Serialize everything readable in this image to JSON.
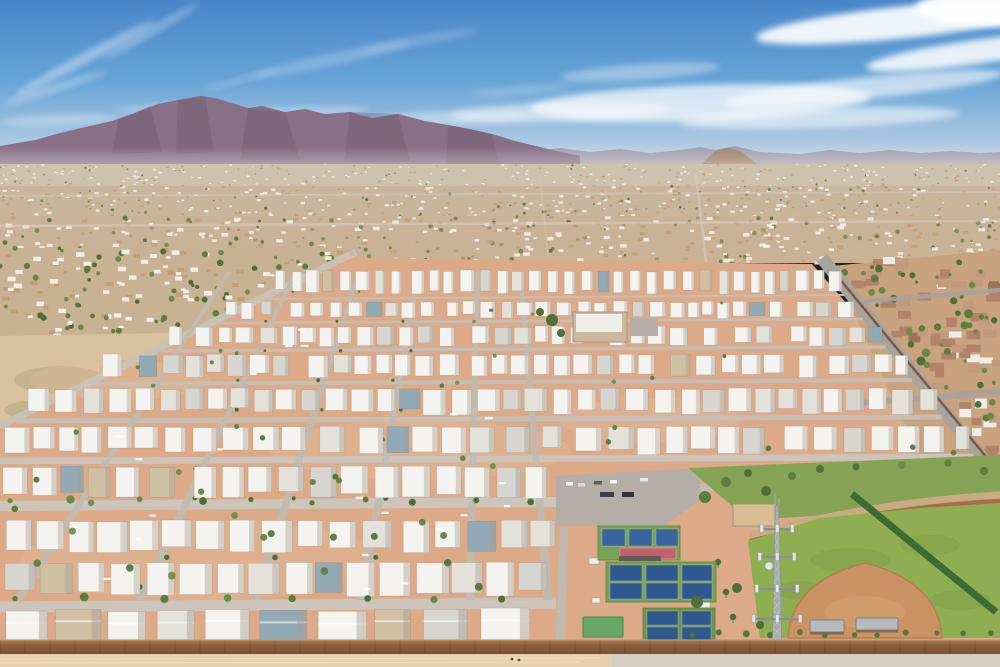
{
  "scene": {
    "description": "Aerial drone photograph of a desert mobile-home community with mountain range on the horizon, dense suburban sprawl, grid of white-roofed mobile homes, pickleball courts, baseball field and a cell tower",
    "width": 1000,
    "height": 667
  },
  "palette": {
    "sky_top": "#4a86c8",
    "sky_mid": "#66a3d6",
    "sky_low": "#a9c6e0",
    "sky_horizon": "#d8e3ea",
    "cloud": "#ffffff",
    "mountain": "#887088",
    "mountain_dark": "#6b5568",
    "mountain_far": "#9a8d9c",
    "foothill": "#9c7a5a",
    "sprawl_roof_white": "#f1efe8",
    "sprawl_roof_tan": "#c49c74",
    "sprawl_dark": "#9b8a74",
    "tree": "#5d7c3e",
    "tree_dark": "#4e7038",
    "tree_light": "#6b8a4a",
    "palm": "#47703a",
    "park_ground": "#dcaa88",
    "park_ground_light": "#e5bd9c",
    "street": "#c6c0b8",
    "street_bright": "#cdc7be",
    "vert_street": "#c0bab1",
    "home_white": "#f4f3ef",
    "home_light": "#e3e1da",
    "home_gray": "#d6d5cf",
    "home_blue": "#92aab6",
    "home_tan": "#cfc0a4",
    "home_shade": "#a89e92",
    "sub_ground": "#c9a37f",
    "sub_roof": "#b2836a",
    "sub_roof_light": "#c29a7e",
    "sub_white": "#f0ede6",
    "sub_dark": "#9c7258",
    "asphalt": "#a7a39d",
    "block_wall": "#7c4f33",
    "court_green": "#79a057",
    "court_green_dark": "#6d9550",
    "court_blue": "#39649c",
    "court_blue2": "#2f588e",
    "court_red": "#c2606b",
    "parking": "#b4aea6",
    "lawn": "#86a355",
    "grass": "#8fae52",
    "grass_dark": "#7d9c46",
    "infield": "#cb9264",
    "infield_edge": "#b57e52",
    "infield_light": "#d8a674",
    "track": "#a96a4e",
    "track_outer": "#c8ab80",
    "tower_gray": "#a8adb0",
    "tower_dark": "#878d90",
    "tower_light": "#e3e6e8",
    "canopy": "#b6babd",
    "hedge": "#3e6b31",
    "green_roof": "#6aa868",
    "club_tan": "#cbb89e",
    "wall_brown": "#8e5f3e",
    "wall_light": "#aa7c55",
    "bottom_dirt": "#e8cfae",
    "bottom_road": "#d5cfc3",
    "sand": "#d8bc92",
    "haze": "#ffffff"
  },
  "sky": {
    "horizon_y": 178
  },
  "clouds": [
    [
      85,
      58,
      80,
      5,
      -28,
      0.4
    ],
    [
      55,
      88,
      55,
      4,
      -18,
      0.3
    ],
    [
      150,
      32,
      55,
      4,
      -30,
      0.3
    ],
    [
      240,
      80,
      40,
      3,
      -15,
      0.2
    ],
    [
      330,
      60,
      80,
      6,
      -12,
      0.22
    ],
    [
      420,
      40,
      60,
      5,
      -10,
      0.18
    ],
    [
      520,
      90,
      50,
      4,
      -5,
      0.2
    ],
    [
      905,
      22,
      150,
      16,
      -6,
      0.9
    ],
    [
      975,
      52,
      110,
      12,
      -8,
      0.85
    ],
    [
      865,
      88,
      140,
      11,
      -6,
      0.6
    ],
    [
      995,
      8,
      80,
      18,
      0,
      0.95
    ],
    [
      700,
      103,
      170,
      18,
      -2,
      0.7
    ],
    [
      560,
      112,
      110,
      10,
      -2,
      0.45
    ],
    [
      820,
      118,
      140,
      10,
      -2,
      0.55
    ],
    [
      640,
      72,
      80,
      8,
      -4,
      0.35
    ],
    [
      450,
      118,
      85,
      7,
      -2,
      0.35
    ],
    [
      300,
      112,
      70,
      5,
      -2,
      0.3
    ],
    [
      170,
      108,
      55,
      4,
      -2,
      0.28
    ],
    [
      60,
      120,
      60,
      5,
      -2,
      0.3
    ]
  ],
  "mountains": {
    "base_y": 168,
    "main": [
      [
        0,
        146
      ],
      [
        35,
        140
      ],
      [
        60,
        133
      ],
      [
        90,
        126
      ],
      [
        112,
        121
      ],
      [
        135,
        113
      ],
      [
        158,
        104
      ],
      [
        178,
        100
      ],
      [
        200,
        96
      ],
      [
        215,
        98
      ],
      [
        228,
        102
      ],
      [
        248,
        108
      ],
      [
        262,
        106
      ],
      [
        285,
        112
      ],
      [
        305,
        109
      ],
      [
        325,
        114
      ],
      [
        350,
        112
      ],
      [
        372,
        118
      ],
      [
        398,
        114
      ],
      [
        425,
        121
      ],
      [
        448,
        125
      ],
      [
        470,
        129
      ],
      [
        492,
        134
      ],
      [
        515,
        141
      ],
      [
        540,
        147
      ],
      [
        560,
        152
      ],
      [
        580,
        156
      ]
    ],
    "facets": [
      [
        [
          118,
          120
        ],
        [
          150,
          106
        ],
        [
          162,
          152
        ],
        [
          112,
          154
        ]
      ],
      [
        [
          178,
          100
        ],
        [
          205,
          96
        ],
        [
          214,
          152
        ],
        [
          176,
          154
        ]
      ],
      [
        [
          248,
          108
        ],
        [
          285,
          112
        ],
        [
          300,
          160
        ],
        [
          240,
          160
        ]
      ],
      [
        [
          350,
          112
        ],
        [
          398,
          114
        ],
        [
          410,
          162
        ],
        [
          344,
          162
        ]
      ],
      [
        [
          448,
          125
        ],
        [
          492,
          134
        ],
        [
          500,
          164
        ],
        [
          446,
          164
        ]
      ]
    ],
    "far": [
      [
        500,
        158
      ],
      [
        530,
        152
      ],
      [
        560,
        148
      ],
      [
        590,
        152
      ],
      [
        620,
        149
      ],
      [
        650,
        153
      ],
      [
        680,
        150
      ],
      [
        700,
        147
      ],
      [
        715,
        150
      ],
      [
        735,
        146
      ],
      [
        760,
        152
      ],
      [
        800,
        154
      ],
      [
        830,
        150
      ],
      [
        860,
        153
      ],
      [
        890,
        150
      ],
      [
        920,
        153
      ],
      [
        950,
        151
      ],
      [
        980,
        153
      ],
      [
        1000,
        152
      ]
    ],
    "far_base": 172,
    "foothill": [
      [
        700,
        166
      ],
      [
        715,
        151
      ],
      [
        728,
        148
      ],
      [
        742,
        152
      ],
      [
        760,
        166
      ]
    ]
  },
  "haze": {
    "y": 146,
    "h": 74
  },
  "sprawl": {
    "bands": [
      {
        "y0": 164,
        "y1": 186,
        "base": "#cfc2ac",
        "n": 330,
        "s0": 1,
        "s1": 2.2,
        "tree": 0.1,
        "tan": 0.25,
        "dark": 0.08,
        "seed": 11
      },
      {
        "y0": 186,
        "y1": 216,
        "base": "#c8b69c",
        "n": 400,
        "s0": 1.5,
        "s1": 3,
        "tree": 0.17,
        "tan": 0.3,
        "dark": 0.08,
        "seed": 22
      },
      {
        "y0": 216,
        "y1": 263,
        "base": "#c9b295",
        "n": 430,
        "s0": 2,
        "s1": 4.5,
        "tree": 0.2,
        "tan": 0.28,
        "dark": 0.07,
        "seed": 33
      }
    ],
    "arterials": [
      [
        0,
        226,
        1000,
        221,
        2.5,
        0.55
      ],
      [
        0,
        196,
        1000,
        192,
        1.8,
        0.45
      ],
      [
        706,
        262,
        696,
        174,
        2.5,
        0.5
      ],
      [
        548,
        256,
        540,
        176,
        1.5,
        0.35
      ]
    ]
  },
  "left_area": {
    "rect": [
      0,
      248,
      356,
      94
    ],
    "base": "#c9b294",
    "n": 230,
    "s0": 3,
    "s1": 6,
    "tree": 0.38,
    "tan": 0.22,
    "dark": 0.06,
    "seed": 44,
    "field": [
      [
        0,
        336
      ],
      [
        212,
        332
      ],
      [
        148,
        426
      ],
      [
        0,
        428
      ]
    ],
    "field_fill": "#d9c29e",
    "patches": [
      [
        60,
        380,
        46,
        14
      ],
      [
        130,
        370,
        30,
        10
      ],
      [
        40,
        410,
        36,
        10
      ]
    ],
    "road": [
      356,
      252,
      0,
      426,
      7
    ]
  },
  "park": {
    "poly": [
      [
        348,
        258
      ],
      [
        812,
        264
      ],
      [
        1000,
        478
      ],
      [
        1000,
        640
      ],
      [
        0,
        640
      ],
      [
        0,
        428
      ]
    ],
    "edge": {
      "lx0": 0,
      "ly0": 428,
      "lx1": 348,
      "ly1": 258,
      "rx0": 822,
      "ry0": 258,
      "rslope": 0.8
    },
    "cross": [
      [
        298,
        2
      ],
      [
        322,
        2.6
      ],
      [
        350,
        3.2
      ],
      [
        383,
        4
      ],
      [
        420,
        5
      ],
      [
        460,
        6.5
      ],
      [
        505,
        10
      ],
      [
        606,
        11
      ]
    ],
    "extra_streets": [
      [
        560,
        506,
        756,
        481,
        8
      ]
    ],
    "verts": {
      "xs": [
        18,
        140,
        255,
        362,
        470,
        548
      ],
      "y_top": 272,
      "y_bot": 600,
      "vp_x": 486,
      "shrink": 0.55,
      "hw": 4.5
    },
    "bands": [
      [
        270,
        296,
        9,
        14,
        50
      ],
      [
        301,
        319,
        11,
        16,
        51
      ],
      [
        326,
        347,
        13,
        18,
        52
      ],
      [
        354,
        379,
        15,
        20,
        53
      ],
      [
        388,
        416,
        17,
        23,
        54
      ],
      [
        426,
        456,
        19,
        26,
        55
      ],
      [
        466,
        501,
        21,
        28,
        56
      ],
      [
        520,
        556,
        23,
        31,
        57
      ],
      [
        562,
        600,
        25,
        33,
        58
      ]
    ],
    "front": {
      "y": 608,
      "x1": 552,
      "seed": 59
    },
    "tree_rows": [
      [
        501,
        10,
        556,
        58
      ],
      [
        599,
        15,
        545,
        64
      ]
    ],
    "trees_n": 48,
    "rv_n": 22,
    "seed": 77
  },
  "clubhouse": {
    "x": 573,
    "y": 312,
    "w": 54,
    "h": 30,
    "lot": [
      630,
      318,
      28,
      18
    ],
    "trees": [
      [
        552,
        320,
        6
      ],
      [
        561,
        333,
        4
      ],
      [
        540,
        312,
        4
      ]
    ]
  },
  "subdivision": {
    "poly": [
      [
        832,
        266
      ],
      [
        1000,
        250
      ],
      [
        1000,
        465
      ],
      [
        925,
        468
      ]
    ],
    "base": "#c9a37f",
    "n": 44,
    "tn": 30,
    "seed": 88,
    "roads": [
      [
        858,
        302,
        1000,
        290,
        4.5
      ],
      [
        846,
        404,
        1000,
        392,
        6
      ]
    ],
    "wall": [
      834,
      272,
      992,
      464,
      2.4
    ],
    "road": [
      822,
      258,
      998,
      478,
      13
    ],
    "hedge": [
      852,
      494,
      996,
      612,
      7
    ]
  },
  "complex": {
    "parking": [
      [
        556,
        476
      ],
      [
        700,
        468
      ],
      [
        700,
        500
      ],
      [
        664,
        526
      ],
      [
        556,
        526
      ]
    ],
    "vehicles": [
      [
        566,
        482,
        7,
        3.5,
        "#f2f2ee"
      ],
      [
        578,
        483,
        7,
        3.5,
        "#d8d8d4"
      ],
      [
        594,
        481,
        8,
        3.5,
        "#5a5e62"
      ],
      [
        610,
        480,
        7,
        3.5,
        "#f2f2ee"
      ],
      [
        640,
        478,
        8,
        3.5,
        "#e8e8e4"
      ],
      [
        600,
        492,
        14,
        5,
        "#3c4048"
      ],
      [
        622,
        492,
        12,
        5,
        "#2f3438"
      ]
    ],
    "street": [
      564,
      528,
      560,
      640,
      9
    ],
    "courts": [
      {
        "pad": [
          598,
          526,
          82,
          34
        ],
        "cells": [
          [
            602,
            529,
            23,
            17
          ],
          [
            629,
            529,
            23,
            17
          ],
          [
            656,
            529,
            22,
            17
          ]
        ],
        "red": [
          620,
          548,
          56,
          11
        ]
      },
      {
        "pad": [
          606,
          562,
          110,
          40
        ],
        "cells": [
          [
            610,
            565,
            32,
            16
          ],
          [
            646,
            565,
            32,
            16
          ],
          [
            682,
            565,
            30,
            16
          ],
          [
            610,
            583,
            32,
            16
          ],
          [
            646,
            583,
            32,
            16
          ],
          [
            682,
            583,
            30,
            16
          ]
        ]
      },
      {
        "pad": [
          643,
          608,
          72,
          34
        ],
        "cells": [
          [
            647,
            611,
            31,
            14
          ],
          [
            682,
            611,
            29,
            14
          ],
          [
            647,
            627,
            31,
            13
          ],
          [
            682,
            627,
            29,
            13
          ]
        ]
      }
    ],
    "canopy_row": [
      619,
      556,
      42,
      5
    ],
    "green_bldg": [
      583,
      617,
      40,
      20
    ],
    "sheds": [
      [
        589,
        558,
        10,
        6
      ],
      [
        700,
        602,
        10,
        6
      ],
      [
        592,
        598,
        8,
        5
      ]
    ],
    "sand": [
      733,
      504,
      42,
      22
    ],
    "lawn": [
      [
        688,
        468
      ],
      [
        1000,
        455
      ],
      [
        1000,
        505
      ],
      [
        748,
        520
      ]
    ],
    "lawn_trees": [
      [
        705,
        497,
        6
      ],
      [
        726,
        482,
        5
      ],
      [
        748,
        473,
        4
      ],
      [
        766,
        491,
        5
      ],
      [
        792,
        476,
        4
      ],
      [
        820,
        469,
        4
      ],
      [
        856,
        467,
        3.5
      ],
      [
        902,
        465,
        4
      ],
      [
        948,
        463,
        3.5
      ],
      [
        984,
        471,
        4
      ]
    ],
    "palms": [
      [
        718,
        562
      ],
      [
        726,
        592
      ],
      [
        733,
        617
      ],
      [
        702,
        641
      ],
      [
        979,
        599
      ]
    ]
  },
  "field": {
    "grass": [
      [
        748,
        541
      ],
      [
        820,
        518
      ],
      [
        920,
        508
      ],
      [
        1000,
        503
      ],
      [
        1000,
        638
      ],
      [
        760,
        638
      ]
    ],
    "mottle": [
      [
        850,
        560,
        40,
        12
      ],
      [
        930,
        545,
        30,
        10
      ],
      [
        800,
        590,
        26,
        9
      ],
      [
        960,
        600,
        30,
        10
      ],
      [
        880,
        615,
        36,
        9
      ]
    ],
    "track": [
      750,
      542,
      880,
      508,
      1000,
      502,
      6
    ],
    "track_outer": [
      750,
      535,
      880,
      501,
      1000,
      495,
      7
    ],
    "infield": "M 788 638 Q 791 582 865 563 Q 939 582 942 638 Z",
    "infield_inner": [
      865,
      612,
      40,
      16
    ],
    "canopies": [
      [
        810,
        620,
        34,
        12
      ],
      [
        856,
        618,
        42,
        12
      ]
    ],
    "bush_row": {
      "x0": 688,
      "x1": 996,
      "step": 27,
      "y": 634
    },
    "trees": [
      [
        697,
        602,
        6
      ],
      [
        737,
        588,
        5
      ],
      [
        760,
        625,
        4
      ]
    ]
  },
  "tower": {
    "x": 777,
    "y_top": 506,
    "y_base": 664,
    "arms": [
      [
        528,
        30
      ],
      [
        556,
        34
      ],
      [
        588,
        40
      ],
      [
        618,
        46
      ]
    ],
    "dish": [
      769,
      566,
      4
    ],
    "base_box": [
      768,
      648,
      20,
      10
    ]
  },
  "wall": {
    "y": 640,
    "h": 14,
    "tick": 25
  },
  "bottom": {
    "y": 654,
    "h": 13,
    "split": 612,
    "figures": [
      [
        512,
        659
      ],
      [
        519,
        660
      ]
    ]
  }
}
